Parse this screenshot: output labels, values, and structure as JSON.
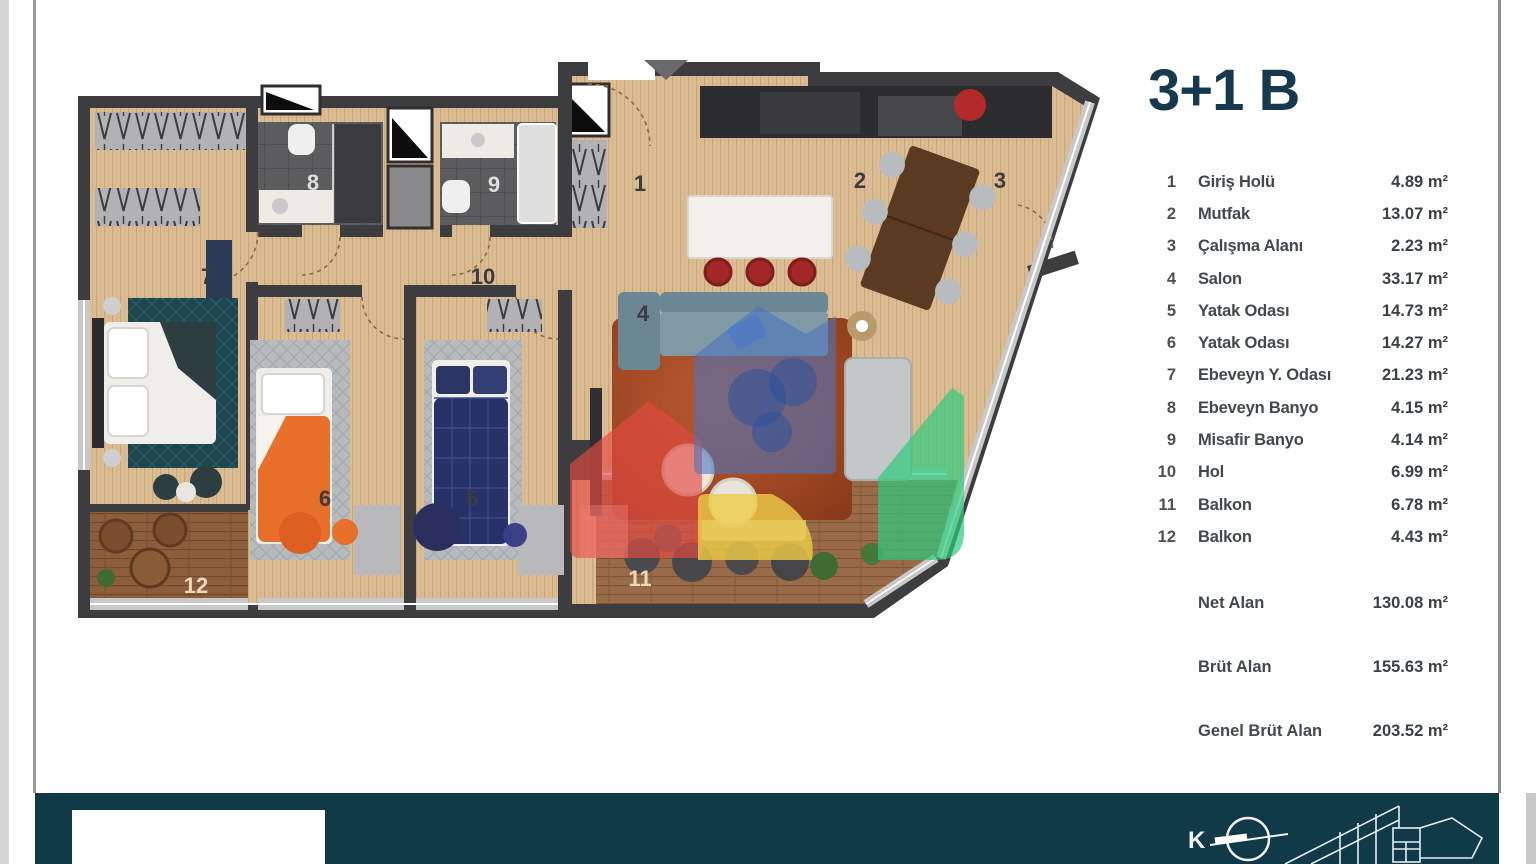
{
  "title": "3+1 B",
  "legend": {
    "rows": [
      {
        "num": "1",
        "name": "Giriş Holü",
        "area": "4.89 m²"
      },
      {
        "num": "2",
        "name": "Mutfak",
        "area": "13.07 m²"
      },
      {
        "num": "3",
        "name": "Çalışma Alanı",
        "area": "2.23 m²"
      },
      {
        "num": "4",
        "name": "Salon",
        "area": "33.17 m²"
      },
      {
        "num": "5",
        "name": "Yatak Odası",
        "area": "14.73 m²"
      },
      {
        "num": "6",
        "name": "Yatak Odası",
        "area": "14.27 m²"
      },
      {
        "num": "7",
        "name": "Ebeveyn Y. Odası",
        "area": "21.23 m²"
      },
      {
        "num": "8",
        "name": "Ebeveyn Banyo",
        "area": "4.15 m²"
      },
      {
        "num": "9",
        "name": "Misafir Banyo",
        "area": "4.14 m²"
      },
      {
        "num": "10",
        "name": "Hol",
        "area": "6.99 m²"
      },
      {
        "num": "11",
        "name": "Balkon",
        "area": "6.78 m²"
      },
      {
        "num": "12",
        "name": "Balkon",
        "area": "4.43 m²"
      }
    ],
    "totals": [
      {
        "label": "Net Alan",
        "value": "130.08 m²"
      },
      {
        "label": "Brüt Alan",
        "value": "155.63 m²"
      },
      {
        "label": "Genel Brüt Alan",
        "value": "203.52 m²"
      }
    ]
  },
  "plan": {
    "rooms": [
      {
        "num": "1"
      },
      {
        "num": "2"
      },
      {
        "num": "3"
      },
      {
        "num": "4"
      },
      {
        "num": "5"
      },
      {
        "num": "6"
      },
      {
        "num": "7"
      },
      {
        "num": "8"
      },
      {
        "num": "9"
      },
      {
        "num": "10"
      },
      {
        "num": "11"
      },
      {
        "num": "12"
      }
    ]
  },
  "footer": {
    "north_label": "K"
  },
  "colors": {
    "footer_teal": "#113a48",
    "title_navy": "#17394e",
    "wall_gray": "#3d3d3f",
    "wood_floor": "#dcbc92",
    "watermark_blue": "#4a74be",
    "watermark_red": "#e34b42",
    "watermark_green": "#2fcb7d",
    "watermark_yellow": "#eecd49"
  }
}
